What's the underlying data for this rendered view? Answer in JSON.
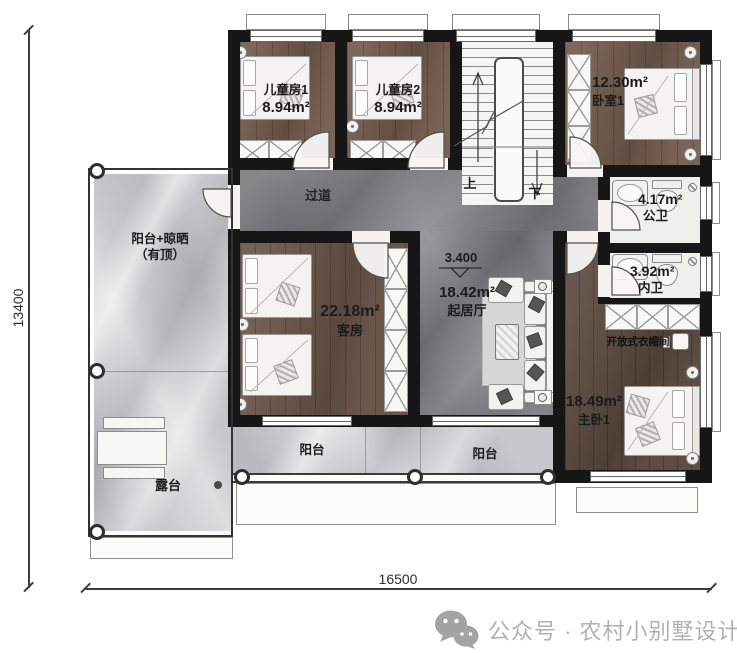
{
  "rooms": {
    "kids1": {
      "name": "儿童房1",
      "area": "8.94m²"
    },
    "kids2": {
      "name": "儿童房2",
      "area": "8.94m²"
    },
    "bedroom1": {
      "name": "卧室1",
      "area": "12.30m²"
    },
    "public_bath": {
      "name": "公卫",
      "area": "4.17m²"
    },
    "inner_bath": {
      "name": "内卫",
      "area": "3.92m²"
    },
    "guest": {
      "name": "客房",
      "area": "22.18m²"
    },
    "living": {
      "name": "起居厅",
      "area": "18.42m²",
      "elevation": "3.400"
    },
    "master": {
      "name": "主卧1",
      "area": "18.49m²"
    },
    "corridor": {
      "name": "过道"
    },
    "closet": {
      "name": "开放式衣帽间"
    },
    "balcony_covered": {
      "name": "阳台+晾晒",
      "sub": "（有顶）"
    },
    "terrace": {
      "name": "露台"
    },
    "balcony_south_1": {
      "name": "阳台"
    },
    "balcony_south_2": {
      "name": "阳台"
    }
  },
  "stairs": {
    "up": "上",
    "down": "下"
  },
  "dimensions": {
    "bottom": "16500",
    "left": "13400"
  },
  "watermark": {
    "text": "公众号 · 农村小别墅设计"
  },
  "colors": {
    "wall": "#161616",
    "wood": "#6b564a",
    "wood_dark": "#5e4d43",
    "marble_dark": "#808082",
    "marble_light": "#c8c8ca",
    "watermark_gray": "#b1b1b1"
  }
}
